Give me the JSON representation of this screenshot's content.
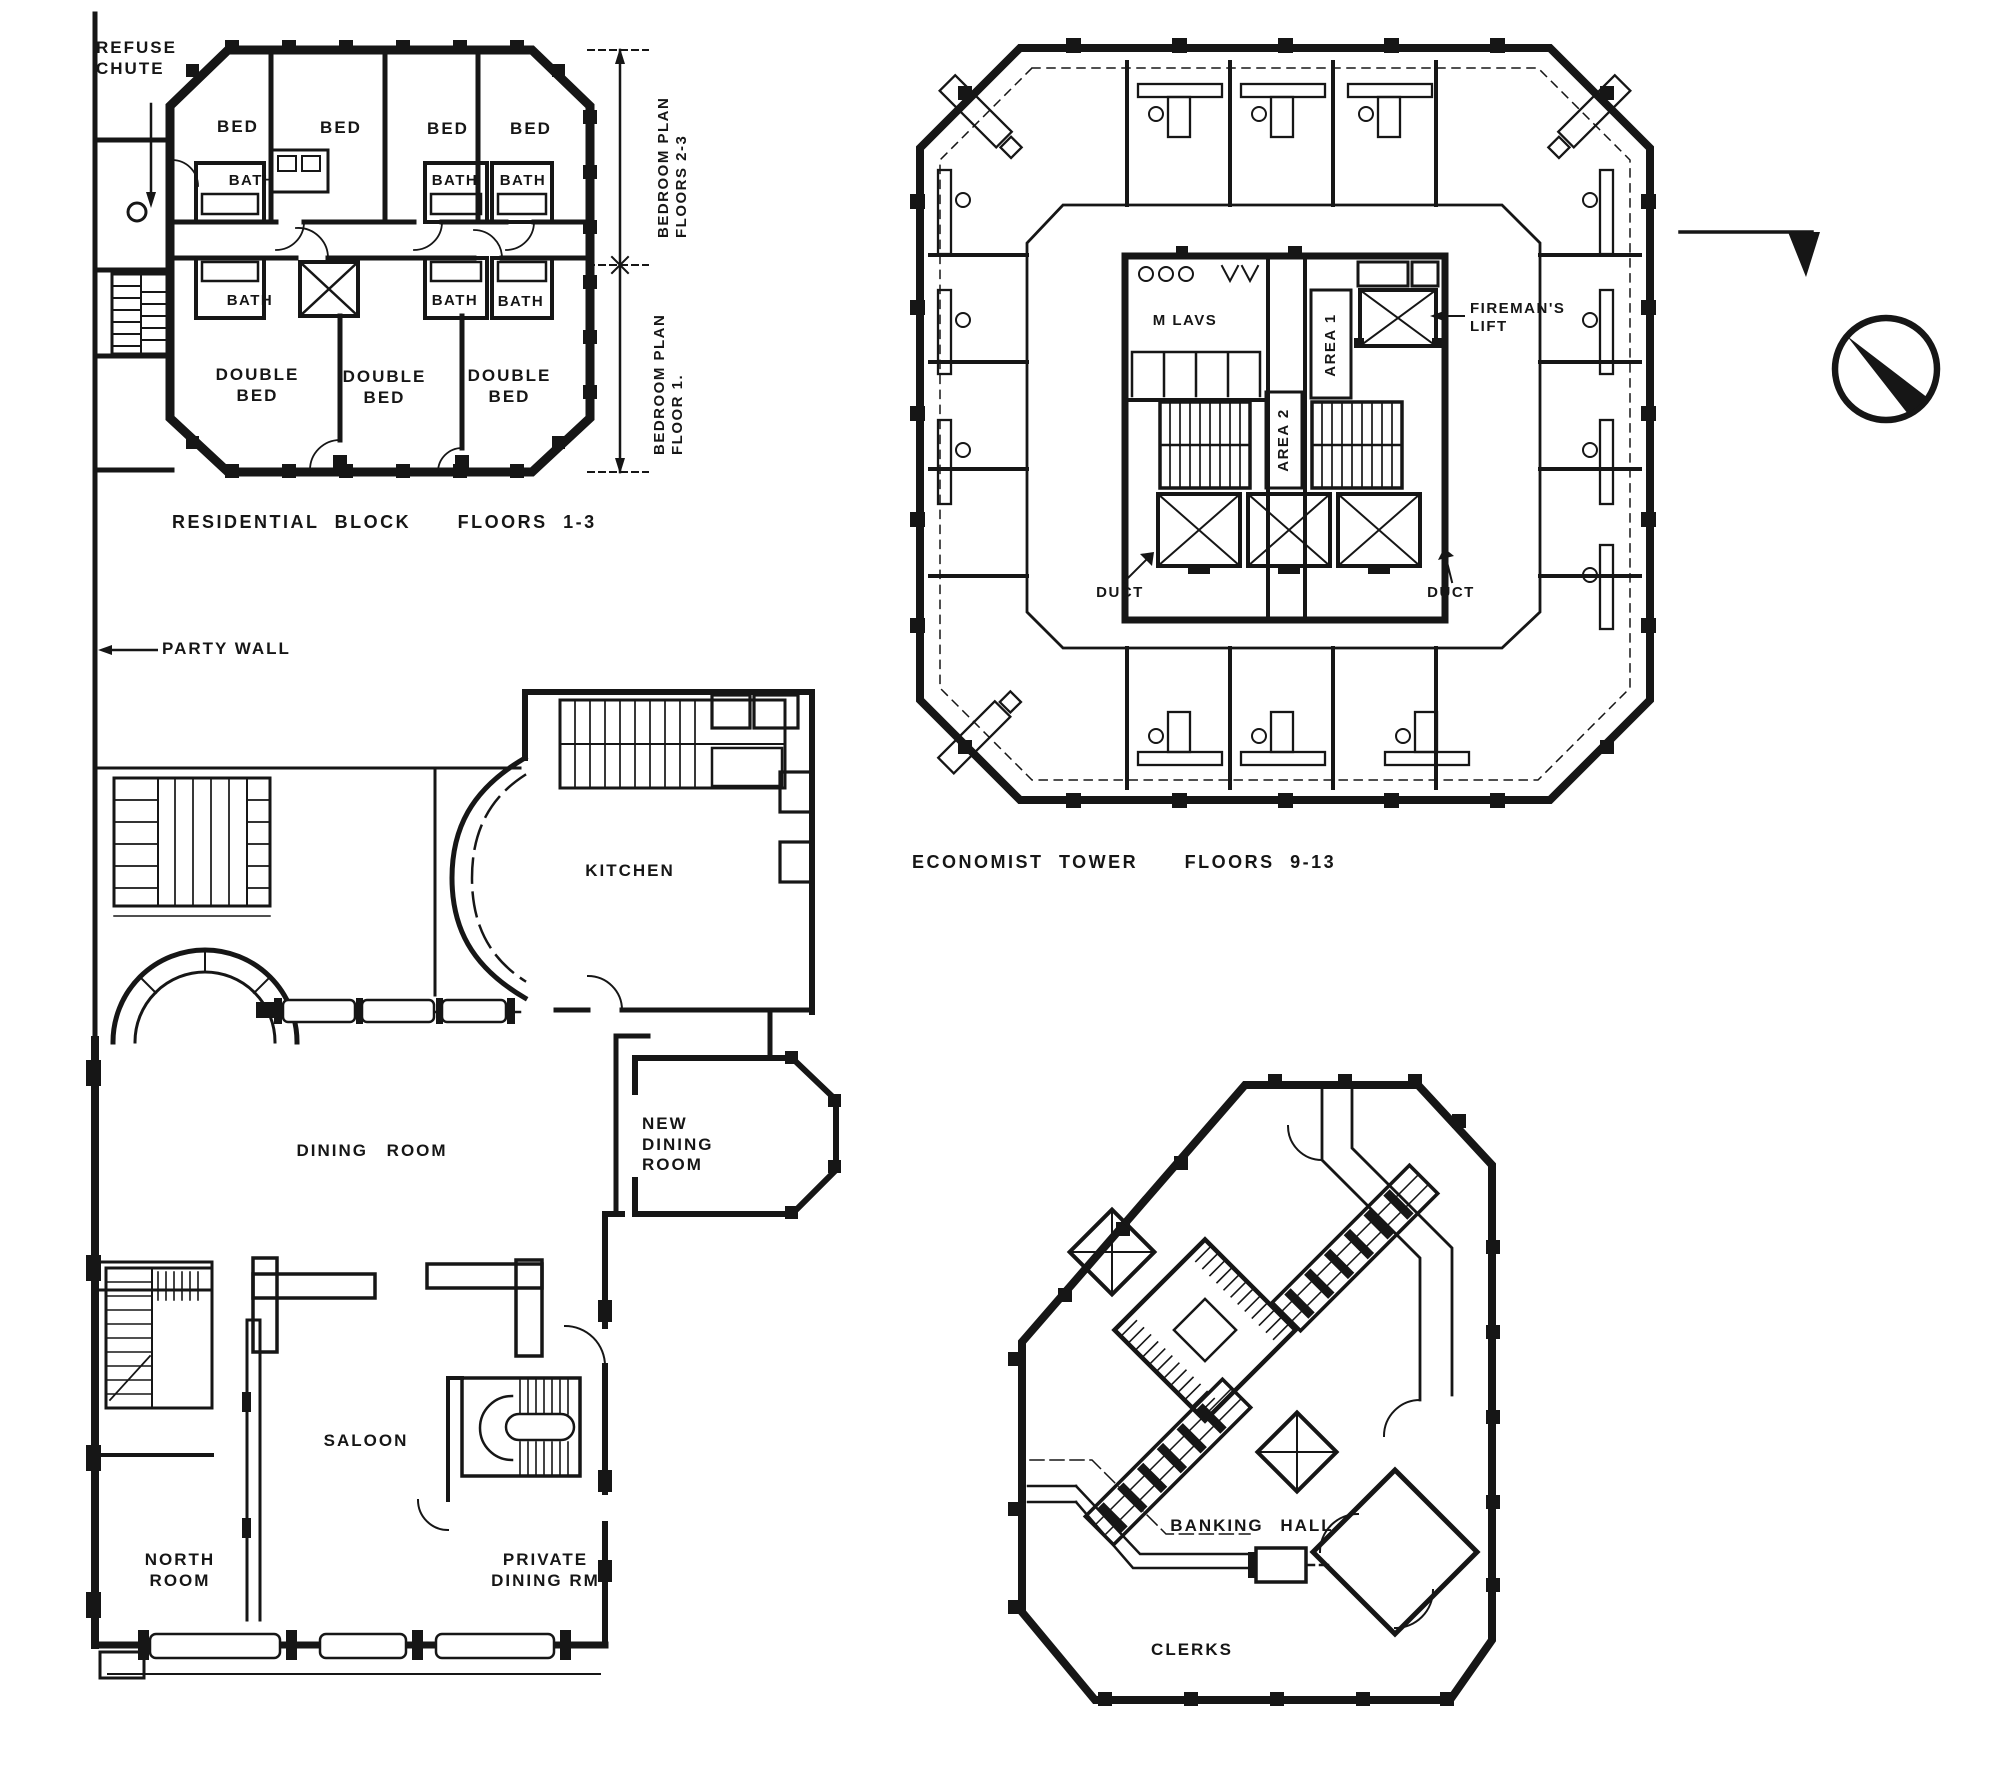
{
  "drawing": {
    "ink_color": "#161616",
    "paper_color": "#ffffff",
    "type": "architectural floor plans"
  },
  "residential_block": {
    "caption": "RESIDENTIAL BLOCK   FLOORS 1-3",
    "refuse_chute_label": "REFUSE CHUTE",
    "party_wall_label": "PARTY WALL",
    "bed_labels": [
      "BED",
      "BED",
      "BED",
      "BED"
    ],
    "bath_labels_upper": [
      "BATH",
      "BATH",
      "BATH"
    ],
    "bath_labels_lower": [
      "BATH",
      "BATH",
      "BATH"
    ],
    "double_bed_labels": [
      "DOUBLE BED",
      "DOUBLE BED",
      "DOUBLE BED"
    ],
    "dim_label_floors_2_3": "BEDROOM PLAN FLOORS 2-3",
    "dim_label_floor_1": "BEDROOM PLAN FLOOR 1."
  },
  "economist_tower": {
    "caption": "ECONOMIST TOWER   FLOORS 9-13",
    "m_lavs_label": "M LAVS",
    "area_1_label": "AREA 1",
    "area_2_label": "AREA 2",
    "firemans_lift_label": "FIREMAN'S LIFT",
    "duct_left_label": "DUCT",
    "duct_right_label": "DUCT"
  },
  "public_house": {
    "kitchen_label": "KITCHEN",
    "dining_room_label": "DINING ROOM",
    "new_dining_room_label": "NEW DINING ROOM",
    "saloon_label": "SALOON",
    "north_room_label": "NORTH ROOM",
    "private_dining_label": "PRIVATE DINING RM"
  },
  "bank": {
    "banking_hall_label": "BANKING HALL",
    "clerks_label": "CLERKS"
  },
  "symbols": {
    "north_symbol": "north-arrow"
  }
}
